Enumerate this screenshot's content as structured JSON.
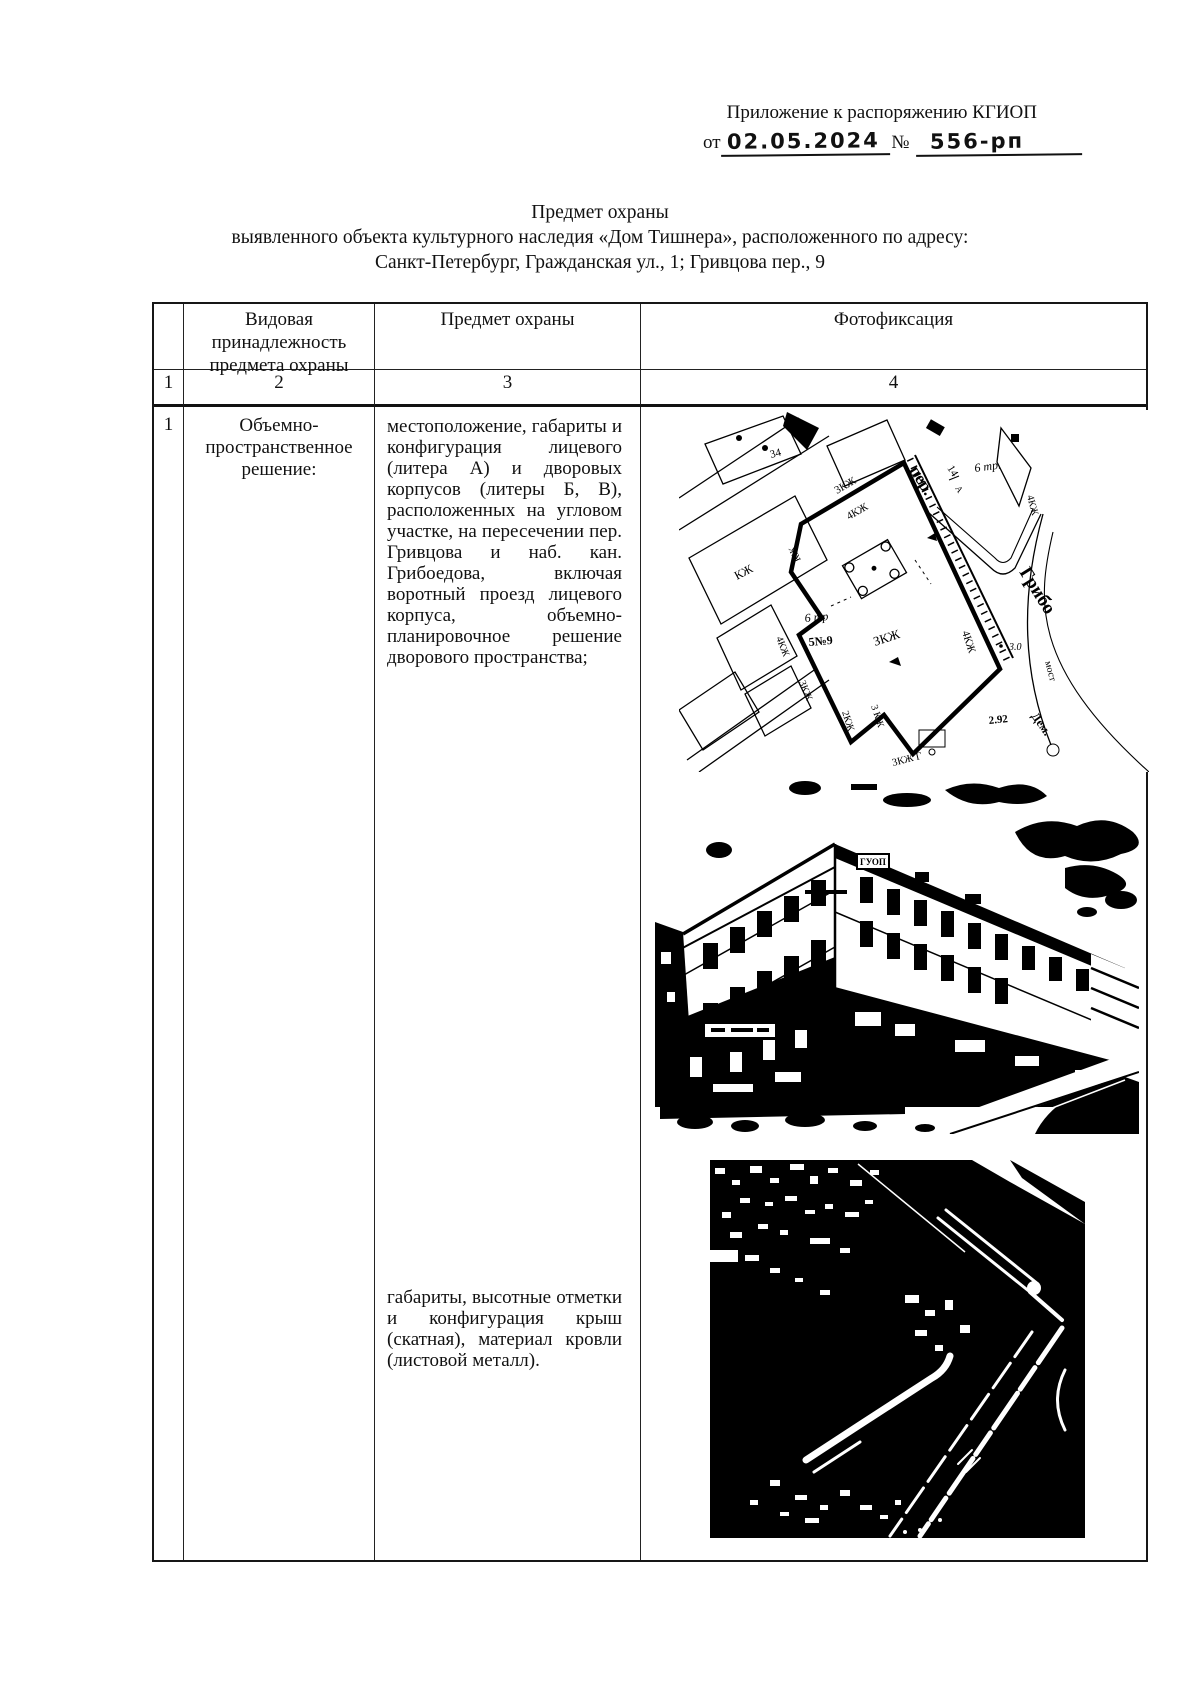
{
  "header": {
    "annex_line": "Приложение к распоряжению КГИОП",
    "from_label": "от",
    "date_handwritten": "02.05.2024",
    "number_sign": "№",
    "number_handwritten": "556-рп"
  },
  "title": {
    "line1": "Предмет охраны",
    "line2": "выявленного объекта культурного наследия «Дом Тишнера», расположенного по адресу:",
    "line3": "Санкт-Петербург, Гражданская ул., 1; Гривцова пер., 9"
  },
  "table": {
    "headers": {
      "col2": "Видовая принадлежность предмета охраны",
      "col3": "Предмет охраны",
      "col4": "Фотофиксация"
    },
    "column_numbers": [
      "1",
      "2",
      "3",
      "4"
    ],
    "row1": {
      "num": "1",
      "category": "Объемно-пространственное решение:",
      "subject_paragraph1": "местоположение, габариты и конфигурация лицевого (литера А) и дворовых корпусов (литеры Б, В), расположенных на угловом участке, на пересечении пер. Гривцова и наб. кан. Грибоедова, включая воротный проезд лицевого корпуса, объемно-планировочное решение дворового пространства;",
      "subject_paragraph2": "габариты, высотные отметки и конфигурация крыш (скатная), материал кровли (листовой металл)."
    }
  },
  "figures": {
    "map": {
      "description": "site plan of the corner parcel at Grivtsova lane and Griboedov canal",
      "labels": {
        "l34": "34",
        "per": "пер.",
        "l14": "14",
        "lA": "А",
        "tr6_ne": "6 тр.",
        "kzh4_ne": "4КЖ",
        "grib": "Грибо",
        "kzh3_top": "3КЖ",
        "kzh4_top": "4КЖ",
        "kzh_vert": "КЖ",
        "kzh_left": "КЖ",
        "tr6_w": "6 тр",
        "n59": "5№9",
        "kzh4_w": "4КЖ",
        "kzh3_w": "3КЖ",
        "zkzh_c": "ЗКЖ",
        "kzh4_e": "4КЖ",
        "kzh2_b": "2КЖ",
        "kzh3_b": "3 КЖ",
        "kzh3_g": "3КЖ Г",
        "d30": "3.0",
        "d292": "2.92",
        "most": "мост",
        "dem": "Дем."
      }
    },
    "photo": {
      "description": "street photo of the corner building (Dom Tishnera)",
      "sign_text": "ГУОП"
    },
    "aerial": {
      "description": "aerial photo of the roofs of the building"
    }
  }
}
